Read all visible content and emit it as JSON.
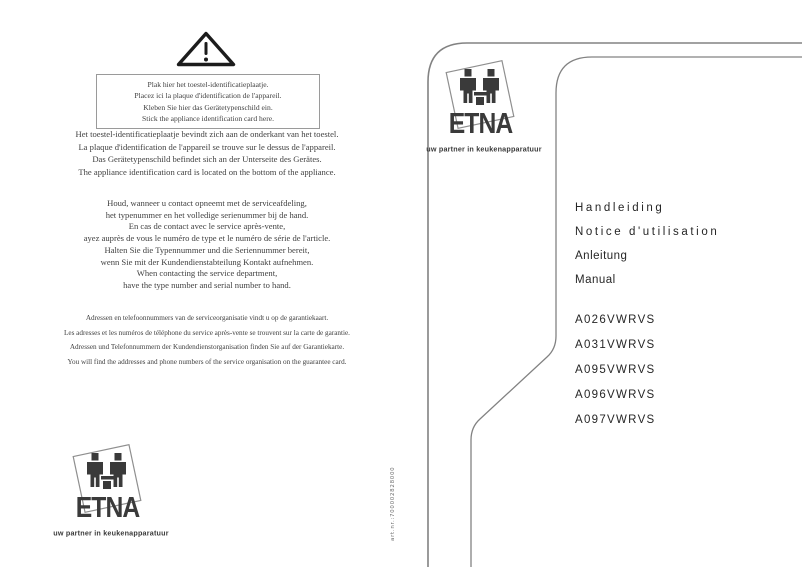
{
  "warning_box": {
    "lines": [
      "Plak hier het toestel-identificatieplaatje.",
      "Placez ici la plaque d'identification de l'appareil.",
      "Kleben Sie hier das Gerätetypenschild ein.",
      "Stick the appliance identification card here."
    ]
  },
  "location_note": {
    "lines": [
      "Het toestel-identificatieplaatje bevindt zich aan de onderkant van het toestel.",
      "La plaque d'identification de l'appareil se trouve sur le dessus de l'appareil.",
      "Das Gerätetypenschild befindet sich an der Unterseite des Gerätes.",
      "The appliance identification card is located on the bottom of the appliance."
    ]
  },
  "service_note": {
    "lines": [
      "Houd, wanneer u contact opneemt met de serviceafdeling,",
      "het typenummer en het volledige serienummer bij de hand.",
      "En cas de contact avec le service après-vente,",
      "ayez auprès de vous le numéro de type et le numéro de série de l'article.",
      "Halten Sie die Typennummer und die Seriennummer bereit,",
      "wenn Sie mit der Kundendienstabteilung Kontakt aufnehmen.",
      "When contacting the service department,",
      "have the type number and serial number to hand."
    ]
  },
  "guarantee_note": {
    "lines": [
      "Adressen en telefoonnummers van de serviceorganisatie vindt u op de garantiekaart.",
      "Les adresses et les numéros de téléphone du service après-vente se trouvent sur la carte de garantie.",
      "Adressen und Telefonnummern der Kundendienstorganisation finden Sie auf der Garantiekarte.",
      "You will find the addresses and phone numbers of the service organisation on the guarantee card."
    ]
  },
  "logo": {
    "brand": "ETNA",
    "tagline": "uw partner in keukenapparatuur"
  },
  "art_number": "art.nr.:700002828000",
  "cover": {
    "titles": [
      "Handleiding",
      "Notice d'utilisation",
      "Anleitung",
      "Manual"
    ],
    "models": [
      "A026VWRVS",
      "A031VWRVS",
      "A095VWRVS",
      "A096VWRVS",
      "A097VWRVS"
    ]
  },
  "icons": {
    "warning": "warning-triangle-icon",
    "figures": "two-people-icon"
  },
  "colors": {
    "text": "#3b3b3b",
    "outline": "#828282",
    "logo": "#3a3a3a"
  }
}
